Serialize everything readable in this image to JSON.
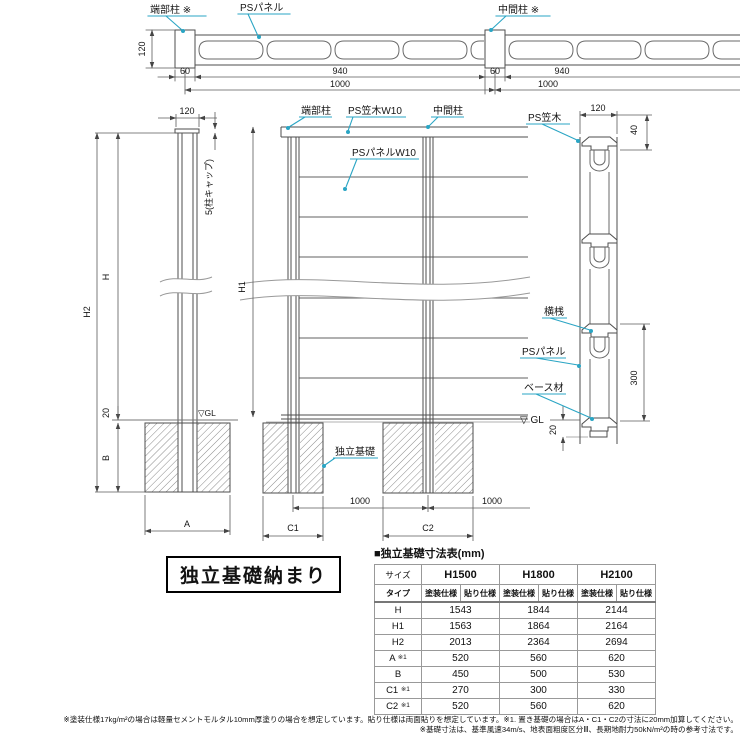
{
  "colors": {
    "leader_teal": "#2aa5c4",
    "line_gray": "#4d4d4d",
    "hatch_gray": "#8a8a8a"
  },
  "plan": {
    "post_end": "端部柱 ※",
    "panel": "PSパネル",
    "post_mid": "中間柱 ※",
    "d120": "120",
    "d60_l": "60",
    "d940_l": "940",
    "d1000_l": "1000",
    "d60_r": "60",
    "d940_r": "940",
    "d1000_r": "1000"
  },
  "side": {
    "d120": "120",
    "cap": "5(柱キャップ)",
    "h": "H",
    "h2": "H2",
    "d20": "20",
    "b": "B",
    "a": "A",
    "gl": "▽GL"
  },
  "front": {
    "post_end": "端部柱",
    "cap": "PS笠木W10",
    "post_mid": "中間柱",
    "panel": "PSパネルW10",
    "foundation": "独立基礎",
    "h1": "H1",
    "d1000_a": "1000",
    "d1000_b": "1000",
    "c1": "C1",
    "c2": "C2"
  },
  "section": {
    "cap": "PS笠木",
    "rail": "横桟",
    "panel": "PSパネル",
    "base": "ベース材",
    "gl": "▽ GL",
    "d120": "120",
    "d40": "40",
    "d300": "300",
    "d20": "20"
  },
  "title_box": "独立基礎納まり",
  "table": {
    "title": "■独立基礎寸法表(mm)",
    "size_header": "サイズ",
    "type_header": "タイプ",
    "sizes": [
      "H1500",
      "H1800",
      "H2100"
    ],
    "spec_headers": [
      "塗装仕様",
      "貼り仕様"
    ],
    "rows": [
      {
        "label": "H",
        "note": "",
        "values": [
          "1543",
          "1844",
          "2144"
        ]
      },
      {
        "label": "H1",
        "note": "",
        "values": [
          "1563",
          "1864",
          "2164"
        ]
      },
      {
        "label": "H2",
        "note": "",
        "values": [
          "2013",
          "2364",
          "2694"
        ]
      },
      {
        "label": "A",
        "note": "※1",
        "values": [
          "520",
          "560",
          "620"
        ]
      },
      {
        "label": "B",
        "note": "",
        "values": [
          "450",
          "500",
          "530"
        ]
      },
      {
        "label": "C1",
        "note": "※1",
        "values": [
          "270",
          "300",
          "330"
        ]
      },
      {
        "label": "C2",
        "note": "※1",
        "values": [
          "520",
          "560",
          "620"
        ]
      }
    ]
  },
  "footnotes": [
    "※塗装仕様17kg/m²の場合は軽量セメントモルタル10mm厚塗りの場合を想定しています。貼り仕様は両面貼りを想定しています。※1. 置き基礎の場合はA・C1・C2の寸法に20mm加算してください。",
    "※基礎寸法は、基準風速34m/s、地表面粗度区分Ⅲ、長期地耐力50kN/m²の時の参考寸法です。"
  ]
}
